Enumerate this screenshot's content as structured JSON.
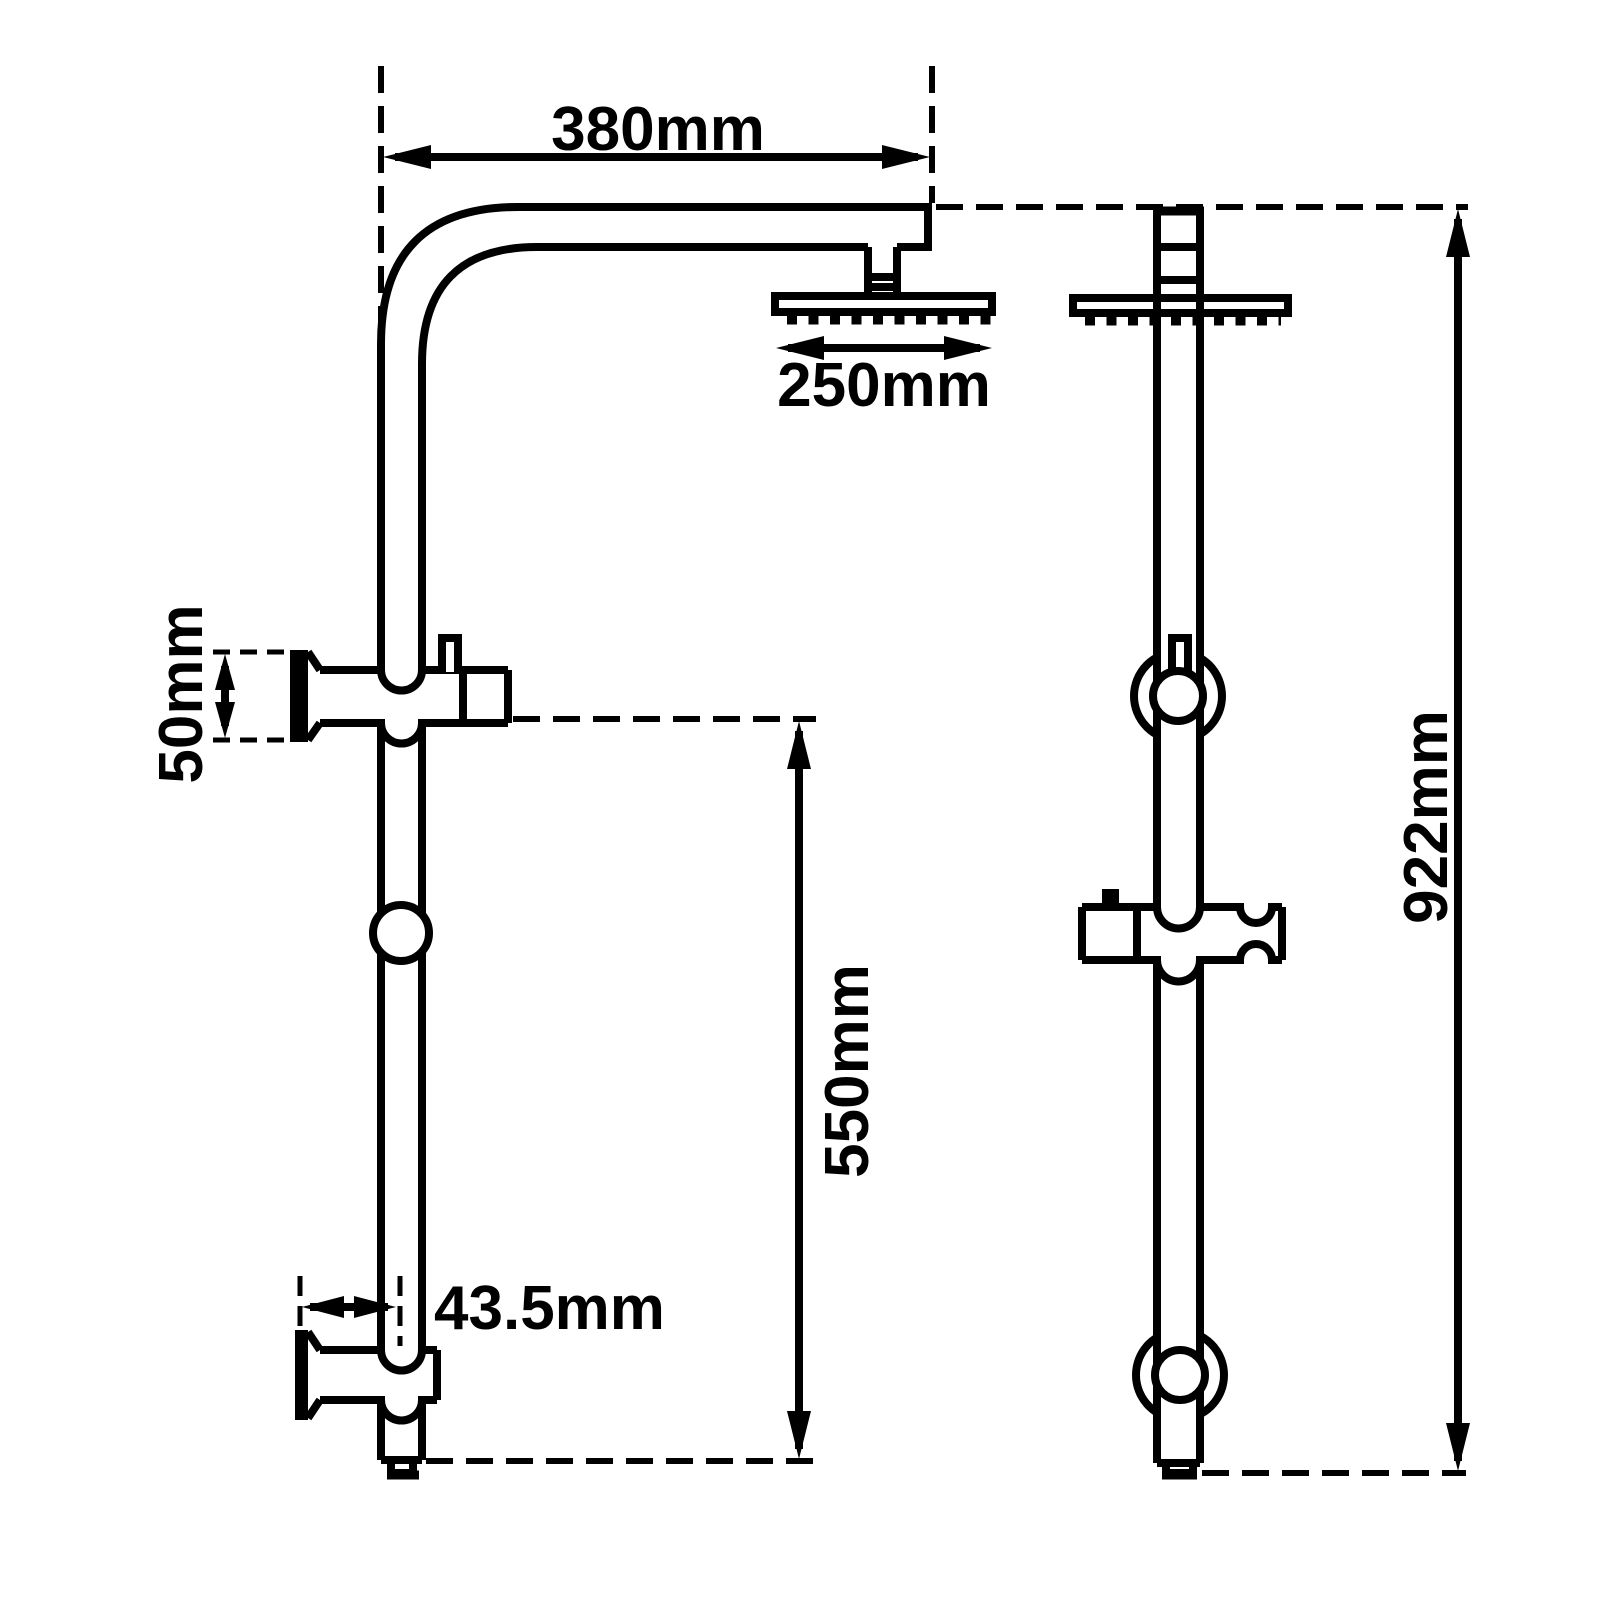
{
  "drawing": {
    "subject": "shower-rail-set-dimension-drawing",
    "background_color": "#ffffff",
    "line_color": "#000000",
    "views": {
      "side_view": {
        "dim_arm_reach": "380mm",
        "dim_head_width": "250mm",
        "dim_top_bracket_height": "50mm",
        "dim_lower_rail_span": "550mm",
        "dim_wall_offset": "43.5mm"
      },
      "front_view": {
        "dim_total_height": "922mm"
      }
    }
  }
}
